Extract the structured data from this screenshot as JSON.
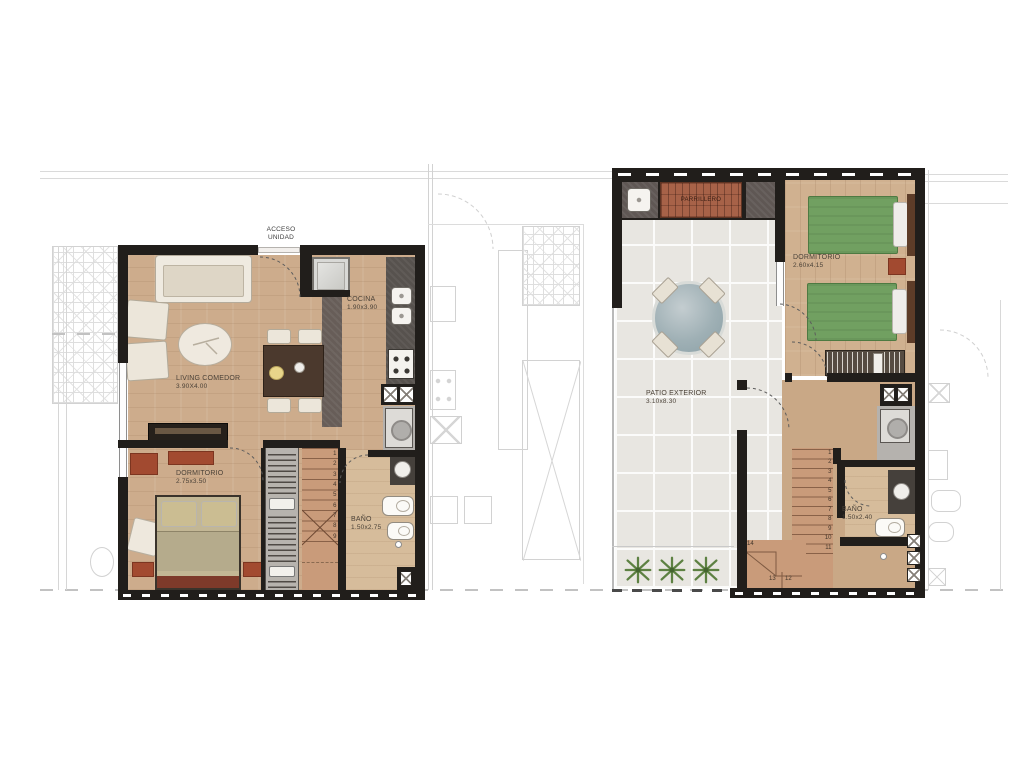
{
  "title": "two-level apartment floor plans",
  "colors": {
    "wall": "#211e1b",
    "wood": "#cdac8c",
    "tile": "#e8e6e1",
    "stair": "#c99b7a",
    "bed_green": "#71a061",
    "accent_red": "#a24a30",
    "closet": "#b7b3ae",
    "counter": "#57524e",
    "faint_line": "#d2d2d2"
  },
  "left_plan": {
    "entry": {
      "line1": "ACCESO",
      "line2": "UNIDAD"
    },
    "rooms": {
      "cocina": {
        "name": "COCINA",
        "dims": "1.90x3.90"
      },
      "living": {
        "name": "LIVING COMEDOR",
        "dims": "3.90X4.00"
      },
      "dormitorio": {
        "name": "DORMITORIO",
        "dims": "2.75x3.50"
      },
      "bano": {
        "name": "BAÑO",
        "dims": "1.50x2.75"
      }
    },
    "stairs": {
      "steps": [
        "1",
        "2",
        "3",
        "4",
        "5",
        "6",
        "7",
        "8",
        "9"
      ]
    }
  },
  "right_plan": {
    "rooms": {
      "parrillero": {
        "name": "PARRILLERO"
      },
      "dormitorio": {
        "name": "DORMITORIO",
        "dims": "2.60x4.15"
      },
      "patio": {
        "name": "PATIO EXTERIOR",
        "dims": "3.10x8.30"
      },
      "bano": {
        "name": "BAÑO",
        "dims": "1.50x2.40"
      }
    },
    "stairs": {
      "steps": [
        "1",
        "2",
        "3",
        "4",
        "5",
        "6",
        "7",
        "8",
        "9",
        "10",
        "11"
      ],
      "landing_steps": [
        "14",
        "13",
        "12"
      ]
    }
  }
}
